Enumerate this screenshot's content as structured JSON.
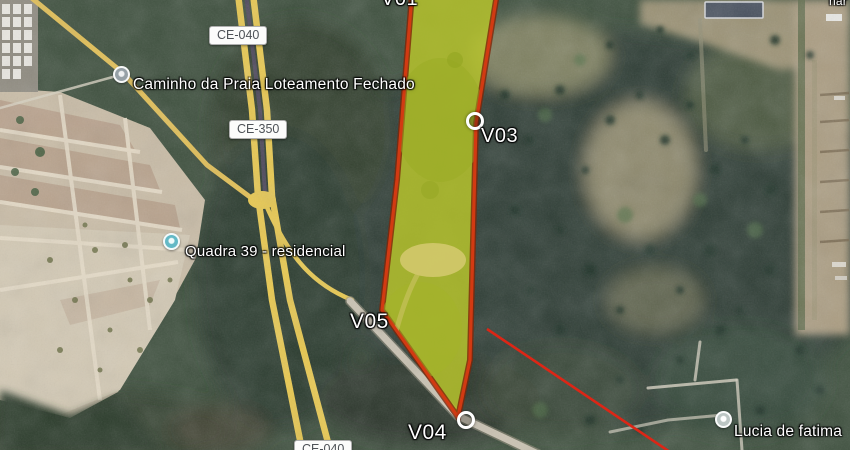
{
  "map_type": "satellite-imagery",
  "road_badges": [
    {
      "id": "ce040-top",
      "text": "CE-040"
    },
    {
      "id": "ce350",
      "text": "CE-350"
    },
    {
      "id": "ce040-bottom",
      "text": "CE-040"
    }
  ],
  "place_labels": [
    {
      "id": "caminho",
      "text": "Caminho da Praia Loteamento Fechado",
      "marker": "gray-poi-dot"
    },
    {
      "id": "quadra39",
      "text": "Quadra 39 - residencial",
      "marker": "teal-poi-dot"
    },
    {
      "id": "lucia",
      "text": "Lucia de fatima",
      "marker": "gray-poi-dot"
    },
    {
      "id": "corner-partial",
      "text": "nar",
      "marker": "none"
    }
  ],
  "property_overlay": {
    "vertex_labels": [
      {
        "id": "v01",
        "label": "V01",
        "marker_visible": false
      },
      {
        "id": "v03",
        "label": "V03",
        "marker_visible": true
      },
      {
        "id": "v04",
        "label": "V04",
        "marker_visible": true
      },
      {
        "id": "v05",
        "label": "V05",
        "marker_visible": false
      }
    ],
    "fill_color": "#b6c32d",
    "border_color": "#d23a12",
    "extra_line_color": "#dc2616"
  },
  "colors": {
    "road_yellow": "#e8c84f",
    "highway_median": "#4a4558",
    "vegetation_dark": "#2d3e34",
    "sand_light": "#d3c9b4",
    "badge_text": "#4e5257"
  }
}
